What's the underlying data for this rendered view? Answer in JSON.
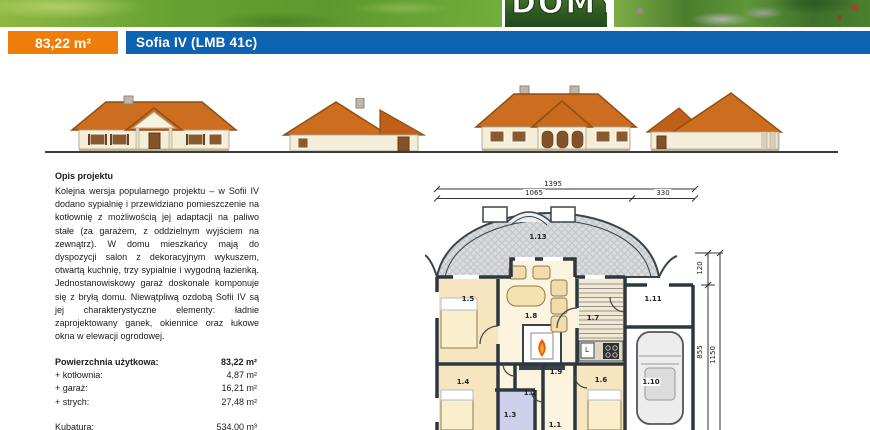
{
  "header": {
    "logo_text": "DOMY",
    "area_badge": "83,22 m²",
    "project_title": "Sofia IV (LMB 41c)",
    "colors": {
      "accent_orange": "#ee7d0a",
      "accent_blue": "#0e63b0"
    }
  },
  "description": {
    "heading": "Opis projektu",
    "body": "Kolejna wersja popularnego projektu – w Sofii IV dodano sypialnię i przewidziano pomieszczenie na kotłownię z możliwością jej adaptacji na paliwo stałe (za garażem, z oddzielnym wyjściem na zewnątrz). W domu mieszkańcy mają do dyspozycji salon z dekoracyjnym wykuszem, otwartą kuchnię, trzy sypialnie i wygodną łazienką. Jednostanowiskowy garaż doskonale komponuje się z bryłą domu. Niewątpliwą ozdobą Sofii IV są jej charakterystyczne elementy: ładnie zaprojektowany ganek, okiennice oraz łukowe okna w elewacji ogrodowej."
  },
  "areas": {
    "rows": [
      {
        "label": "Powierzchnia użytkowa:",
        "value": "83,22 m²"
      },
      {
        "label": "+ kotłownia:",
        "value": "4,87 m²"
      },
      {
        "label": "+ garaż:",
        "value": "16,21 m²"
      },
      {
        "label": "+ strych:",
        "value": "27,48 m²"
      }
    ],
    "kubatura_label": "Kubatura:",
    "kubatura_value": "534,00 m³"
  },
  "floor_plan": {
    "dimensions": {
      "top_total": "1395",
      "top_left": "1065",
      "top_right": "330",
      "right_upper": "120",
      "right_mid": "855",
      "right_outer": "1150"
    },
    "rooms": [
      {
        "id": "1.13"
      },
      {
        "id": "1.5"
      },
      {
        "id": "1.8"
      },
      {
        "id": "1.7"
      },
      {
        "id": "1.11"
      },
      {
        "id": "1.4"
      },
      {
        "id": "1.2"
      },
      {
        "id": "1.3"
      },
      {
        "id": "1.9"
      },
      {
        "id": "1.6"
      },
      {
        "id": "1.10"
      },
      {
        "id": "1.1"
      }
    ],
    "washer_label": "L"
  }
}
